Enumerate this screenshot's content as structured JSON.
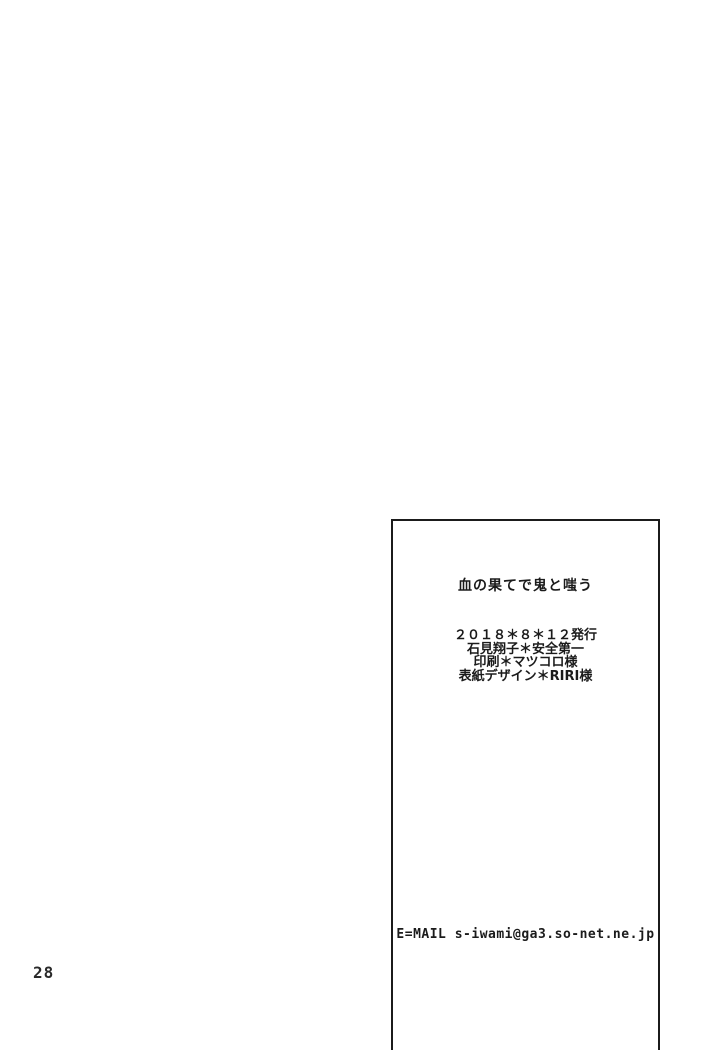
{
  "page": {
    "page_number": "28"
  },
  "colophon": {
    "title": "血の果てで鬼と嗤う",
    "credits": [
      "２０１８＊８＊１２発行",
      "石見翔子＊安全第一",
      "印刷＊マツコロ様",
      "表紙デザイン＊RIRI様"
    ],
    "email": "E=MAIL s-iwami@ga3.so-net.ne.jp"
  },
  "colors": {
    "paper": "#ffffff",
    "ink": "#1b1b1b"
  }
}
